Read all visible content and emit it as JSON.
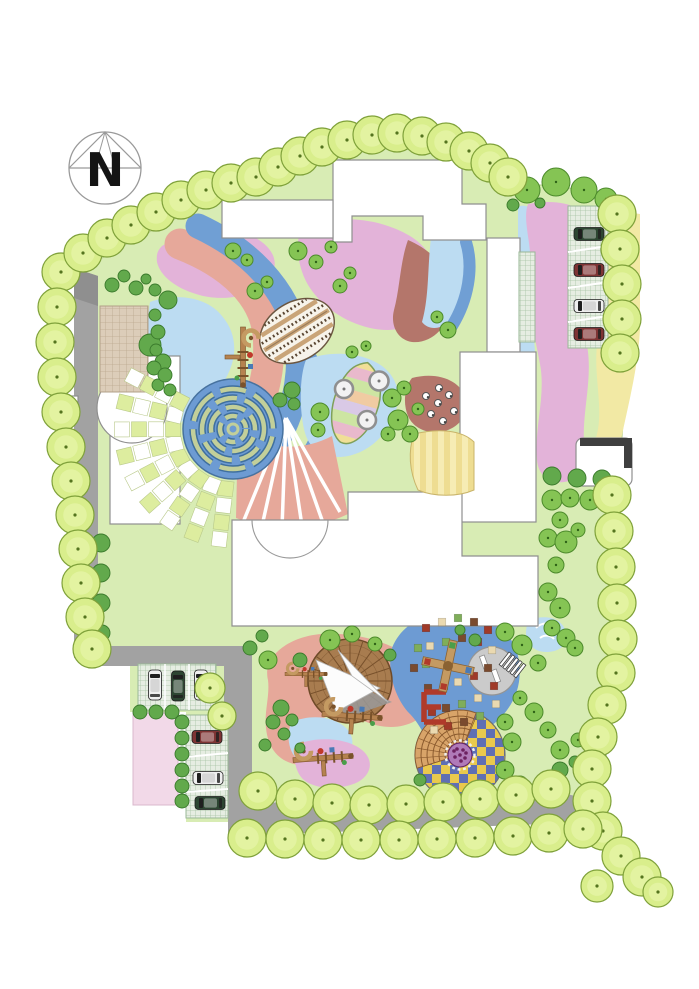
{
  "compass": {
    "label": "N",
    "cx": 105,
    "cy": 168,
    "r": 36
  },
  "palette": {
    "page": "#ffffff",
    "lawn": "#d8ecb4",
    "lawnEdge": "#b9d18c",
    "road": "#a2a2a2",
    "roadDark": "#8f8f8f",
    "building": "#ffffff",
    "buildingEdge": "#8f8f8f",
    "borderTree": "#d9ee8c",
    "borderTreeEdge": "#7fa13a",
    "borderTreeInner": "#e6f4a8",
    "borderTreeDot": "#55741f",
    "canopy": "#85c454",
    "canopyEdge": "#4c8a2b",
    "canopyDot": "#2f6317",
    "bush": "#62a94c",
    "bushEdge": "#3a7a2c",
    "pink": "#e3b3d9",
    "pinkPale": "#f2d9e8",
    "salmon": "#e6a89a",
    "terracotta": "#b4766b",
    "blue": "#709fd4",
    "bluePale": "#bcdcf2",
    "bluePlay": "#6d9bd3",
    "yellow": "#f2e9a4",
    "checkerCell": "#dded9f",
    "gridGreenBase": "#e6ede2",
    "gridGreenLine": "#a7c3a4",
    "gridTanBase": "#dccdb9",
    "gridTanLine": "#bba88e",
    "deckA": "#eedd92",
    "deckB": "#f6ecb4",
    "amphiStep": "#d8a469",
    "amphiLine": "#8a5a2e",
    "chkYellow": "#e9c94d",
    "chkBlue": "#5f6fb4",
    "flower": "#b07ab8",
    "flowerDot": "#6d2160",
    "deckWood": "#a87c4f",
    "deckWoodLine": "#77502b",
    "sail": "#fcfcfc",
    "sailShadow": "#9a9a9a",
    "sand": "#cbcbcb",
    "sandEdge": "#949494",
    "mazeHedge": "#c2cf9a",
    "mazeHedgeEdge": "#3f6f9e",
    "carGreen": "#2d4632",
    "carRed": "#7e3434",
    "carWhite": "#efefef",
    "carGlass": "#1f1f1f",
    "mosaic": [
      "#a03a28",
      "#ead9b0",
      "#7fae5a",
      "#7a4a2e"
    ],
    "playWood": "#b5824f",
    "playWoodDark": "#7a522a",
    "red": "#b03a2a"
  },
  "trees": {
    "border": [
      [
        61,
        272
      ],
      [
        57,
        307
      ],
      [
        55,
        342
      ],
      [
        57,
        377
      ],
      [
        61,
        412
      ],
      [
        66,
        447
      ],
      [
        71,
        481
      ],
      [
        75,
        515
      ],
      [
        78,
        549
      ],
      [
        81,
        583
      ],
      [
        85,
        617
      ],
      [
        92,
        649
      ],
      [
        83,
        253
      ],
      [
        107,
        238
      ],
      [
        131,
        225
      ],
      [
        156,
        212
      ],
      [
        181,
        200
      ],
      [
        206,
        190
      ],
      [
        231,
        183
      ],
      [
        256,
        177
      ],
      [
        278,
        167
      ],
      [
        300,
        156
      ],
      [
        322,
        147
      ],
      [
        347,
        140
      ],
      [
        372,
        135
      ],
      [
        397,
        133
      ],
      [
        422,
        136
      ],
      [
        446,
        142
      ],
      [
        469,
        151
      ],
      [
        490,
        163
      ],
      [
        508,
        177
      ],
      [
        617,
        214
      ],
      [
        620,
        249
      ],
      [
        622,
        284
      ],
      [
        622,
        319
      ],
      [
        620,
        353
      ],
      [
        612,
        495
      ],
      [
        614,
        531
      ],
      [
        616,
        567
      ],
      [
        617,
        603
      ],
      [
        618,
        639
      ],
      [
        616,
        673
      ],
      [
        607,
        705
      ],
      [
        598,
        737
      ],
      [
        592,
        769
      ],
      [
        592,
        801
      ],
      [
        603,
        831
      ],
      [
        621,
        856
      ],
      [
        642,
        877
      ],
      [
        658,
        892,
        15
      ],
      [
        258,
        791
      ],
      [
        295,
        799
      ],
      [
        332,
        803
      ],
      [
        369,
        805
      ],
      [
        406,
        804
      ],
      [
        443,
        802
      ],
      [
        480,
        799
      ],
      [
        516,
        795
      ],
      [
        551,
        789
      ],
      [
        247,
        838
      ],
      [
        285,
        839
      ],
      [
        323,
        840
      ],
      [
        361,
        840
      ],
      [
        399,
        840
      ],
      [
        437,
        839
      ],
      [
        475,
        838
      ],
      [
        513,
        836
      ],
      [
        549,
        833
      ],
      [
        583,
        829
      ],
      [
        210,
        688,
        15
      ],
      [
        222,
        716,
        14
      ],
      [
        597,
        886,
        16
      ]
    ],
    "canopy": [
      [
        527,
        190,
        13
      ],
      [
        556,
        182,
        14
      ],
      [
        584,
        190,
        13
      ],
      [
        606,
        199,
        11
      ],
      [
        233,
        251,
        8
      ],
      [
        247,
        260,
        6
      ],
      [
        298,
        251,
        9
      ],
      [
        316,
        262,
        7
      ],
      [
        331,
        247,
        6
      ],
      [
        255,
        291,
        8
      ],
      [
        267,
        282,
        6
      ],
      [
        340,
        286,
        7
      ],
      [
        350,
        273,
        6
      ],
      [
        448,
        330,
        8
      ],
      [
        437,
        317,
        6
      ],
      [
        320,
        412,
        9
      ],
      [
        318,
        430,
        7
      ],
      [
        392,
        398,
        9
      ],
      [
        404,
        388,
        7
      ],
      [
        398,
        420,
        10
      ],
      [
        388,
        434,
        7
      ],
      [
        410,
        434,
        8
      ],
      [
        418,
        409,
        6
      ],
      [
        352,
        352,
        6
      ],
      [
        366,
        346,
        5
      ],
      [
        330,
        640,
        10
      ],
      [
        352,
        634,
        8
      ],
      [
        375,
        644,
        7
      ],
      [
        268,
        660,
        9
      ],
      [
        505,
        632,
        9
      ],
      [
        522,
        645,
        10
      ],
      [
        538,
        663,
        8
      ],
      [
        520,
        698,
        7
      ],
      [
        534,
        712,
        9
      ],
      [
        548,
        730,
        8
      ],
      [
        560,
        750,
        9
      ],
      [
        578,
        740,
        7
      ],
      [
        598,
        756,
        8
      ],
      [
        505,
        770,
        9
      ],
      [
        520,
        784,
        8
      ],
      [
        505,
        722,
        8
      ],
      [
        512,
        742,
        9
      ],
      [
        552,
        500,
        10
      ],
      [
        570,
        498,
        9
      ],
      [
        590,
        500,
        10
      ],
      [
        560,
        520,
        8
      ],
      [
        548,
        538,
        9
      ],
      [
        566,
        542,
        11
      ],
      [
        578,
        530,
        7
      ],
      [
        556,
        565,
        8
      ],
      [
        548,
        592,
        9
      ],
      [
        560,
        608,
        10
      ],
      [
        552,
        628,
        8
      ],
      [
        566,
        638,
        9
      ],
      [
        575,
        648,
        8
      ]
    ],
    "bush": [
      [
        168,
        300,
        9
      ],
      [
        150,
        345,
        11
      ],
      [
        163,
        362,
        8
      ],
      [
        112,
        285,
        7
      ],
      [
        124,
        276,
        6
      ],
      [
        136,
        288,
        7
      ],
      [
        146,
        279,
        5
      ],
      [
        155,
        290,
        6
      ],
      [
        155,
        315,
        6
      ],
      [
        158,
        332,
        7
      ],
      [
        156,
        350,
        6
      ],
      [
        154,
        368,
        7
      ],
      [
        158,
        385,
        6
      ],
      [
        165,
        375,
        7
      ],
      [
        170,
        390,
        6
      ],
      [
        101,
        543,
        9
      ],
      [
        101,
        573,
        9
      ],
      [
        101,
        603,
        9
      ],
      [
        102,
        633,
        8
      ],
      [
        281,
        708,
        8
      ],
      [
        292,
        720,
        6
      ],
      [
        273,
        722,
        7
      ],
      [
        284,
        734,
        6
      ],
      [
        265,
        745,
        6
      ],
      [
        300,
        748,
        5
      ],
      [
        250,
        648,
        7
      ],
      [
        262,
        636,
        6
      ],
      [
        390,
        655,
        6
      ],
      [
        300,
        660,
        7
      ],
      [
        560,
        770,
        8
      ],
      [
        575,
        762,
        6
      ],
      [
        420,
        780,
        6
      ],
      [
        552,
        476,
        9
      ],
      [
        577,
        478,
        9
      ],
      [
        602,
        479,
        9
      ],
      [
        513,
        205,
        6
      ],
      [
        540,
        203,
        5
      ],
      [
        292,
        390,
        8
      ],
      [
        280,
        400,
        7
      ],
      [
        294,
        404,
        6
      ],
      [
        475,
        640,
        6
      ],
      [
        460,
        630,
        5
      ],
      [
        140,
        712,
        7
      ],
      [
        156,
        712,
        7
      ],
      [
        172,
        712,
        7
      ],
      [
        182,
        722,
        7
      ],
      [
        182,
        738,
        7
      ],
      [
        182,
        754,
        7
      ],
      [
        182,
        770,
        7
      ],
      [
        182,
        786,
        7
      ],
      [
        182,
        801,
        7
      ]
    ]
  },
  "cars": [
    {
      "x": 589,
      "y": 234,
      "rot": 0,
      "color": "carGreen"
    },
    {
      "x": 589,
      "y": 270,
      "rot": 0,
      "color": "carRed"
    },
    {
      "x": 589,
      "y": 306,
      "rot": 0,
      "color": "carWhite"
    },
    {
      "x": 589,
      "y": 334,
      "rot": 0,
      "color": "carRed"
    },
    {
      "x": 155,
      "y": 685,
      "rot": 90,
      "color": "carWhite"
    },
    {
      "x": 178,
      "y": 686,
      "rot": 90,
      "color": "carGreen"
    },
    {
      "x": 201,
      "y": 685,
      "rot": 90,
      "color": "carWhite"
    },
    {
      "x": 207,
      "y": 737,
      "rot": 0,
      "color": "carRed"
    },
    {
      "x": 208,
      "y": 778,
      "rot": 0,
      "color": "carWhite"
    },
    {
      "x": 210,
      "y": 803,
      "rot": 0,
      "color": "carGreen"
    }
  ],
  "features": {
    "maze": {
      "cx": 233,
      "cy": 429,
      "r": 50,
      "rings": [
        [
          40,
          "34 8 26 9 40 8",
          12
        ],
        [
          31,
          "28 8 22 8 34 8",
          -30
        ],
        [
          22,
          "20 7 16 7 24 7",
          40
        ],
        [
          13,
          "12 6 9 6 14 6",
          0
        ]
      ]
    },
    "checker_fan": {
      "cx": 233,
      "cy": 429,
      "r0": 60,
      "dr": 17,
      "rings": 4,
      "a0": 97,
      "a1": 208,
      "da": 13.8,
      "cell": 15
    },
    "stripe_fan": {
      "apex": [
        286,
        418
      ],
      "ends": [
        [
          244,
          520
        ],
        [
          262,
          526
        ],
        [
          282,
          528
        ],
        [
          302,
          526
        ],
        [
          322,
          520
        ],
        [
          340,
          512
        ]
      ]
    },
    "amphitheater": {
      "cx": 460,
      "cy": 755,
      "r": 45,
      "wedge": [
        163,
        293
      ],
      "stepRadii": [
        15,
        21,
        27,
        33,
        39
      ],
      "flowerR": 12
    },
    "tent": {
      "cx": 350,
      "cy": 681,
      "r": 42,
      "shadow": [
        [
          322,
          668
        ],
        [
          392,
          702
        ],
        [
          346,
          718
        ]
      ],
      "sails": [
        [
          [
            316,
            660
          ],
          [
            380,
            688
          ],
          [
            336,
            712
          ]
        ],
        [
          [
            338,
            650
          ],
          [
            388,
            702
          ],
          [
            352,
            676
          ]
        ]
      ]
    },
    "sand_circle": {
      "cx": 492,
      "cy": 671,
      "r": 24
    },
    "leaf_plaza": {
      "cx": 297,
      "cy": 331,
      "rx": 40,
      "ry": 29,
      "rot": -32,
      "bandYs": [
        -22,
        -15,
        -8,
        -1,
        6,
        13,
        20
      ]
    },
    "rainbow_leaf": {
      "cx": 356,
      "cy": 403,
      "rot": 16,
      "bands": [
        "#f0df96",
        "#e9b9cc",
        "#cde5a2",
        "#f0cba2",
        "#d9c9e6",
        "#cde5a2",
        "#e9b9cc",
        "#f0df96"
      ],
      "discs": [
        [
          344,
          389,
          9
        ],
        [
          379,
          381,
          9.5
        ],
        [
          367,
          420,
          9
        ]
      ]
    },
    "play_structures": [
      {
        "x": 243,
        "y": 357,
        "rot": 90,
        "s": 1
      },
      {
        "x": 352,
        "y": 716,
        "rot": 4,
        "s": 1
      },
      {
        "x": 323,
        "y": 758,
        "rot": -4,
        "s": 1
      },
      {
        "x": 306,
        "y": 674,
        "rot": 0,
        "s": 0.7
      }
    ],
    "cross_structure": {
      "x": 448,
      "y": 666,
      "rot": 12
    },
    "benches": [
      [
        484,
        662,
        -20
      ],
      [
        496,
        676,
        -20
      ]
    ],
    "mosaic_squares": [
      [
        426,
        628
      ],
      [
        442,
        622
      ],
      [
        458,
        618
      ],
      [
        474,
        622
      ],
      [
        488,
        630
      ],
      [
        430,
        646
      ],
      [
        446,
        642
      ],
      [
        462,
        638
      ],
      [
        478,
        642
      ],
      [
        492,
        650
      ],
      [
        426,
        664
      ],
      [
        488,
        668
      ],
      [
        474,
        676
      ],
      [
        458,
        682
      ],
      [
        444,
        686
      ],
      [
        428,
        688
      ],
      [
        494,
        686
      ],
      [
        478,
        698
      ],
      [
        462,
        704
      ],
      [
        446,
        708
      ],
      [
        432,
        712
      ],
      [
        496,
        704
      ],
      [
        480,
        716
      ],
      [
        464,
        722
      ],
      [
        448,
        726
      ],
      [
        434,
        730
      ],
      [
        418,
        648
      ],
      [
        414,
        668
      ]
    ],
    "stepping_stones": [
      [
        426,
        396
      ],
      [
        438,
        403
      ],
      [
        449,
        395
      ],
      [
        431,
        414
      ],
      [
        443,
        421
      ],
      [
        454,
        411
      ],
      [
        439,
        388
      ]
    ]
  }
}
